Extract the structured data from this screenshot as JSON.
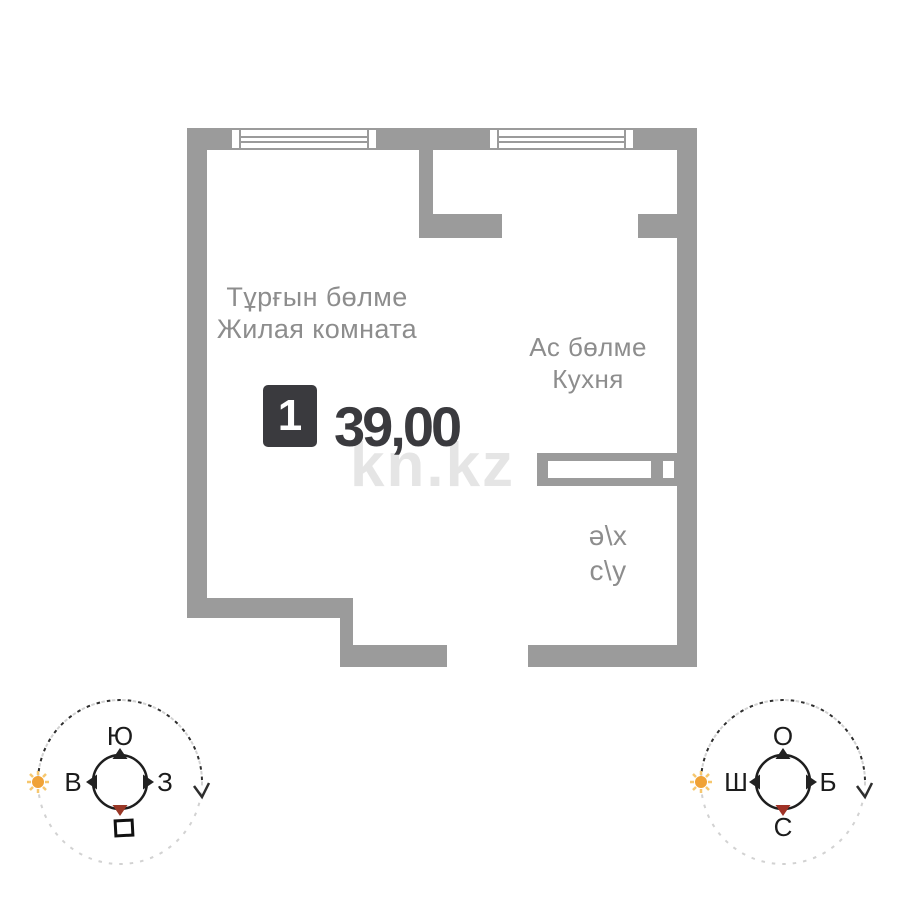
{
  "plan": {
    "watermark": "kn.kz",
    "unit": {
      "badge": "1",
      "area": "39,00"
    },
    "rooms": {
      "living": {
        "kk": "Тұрғын бөлме",
        "ru": "Жилая комната"
      },
      "kitchen": {
        "kk": "Ас бөлме",
        "ru": "Кухня"
      },
      "sanunit": {
        "kk": "ә\\х",
        "ru": "с\\у"
      }
    },
    "colors": {
      "wall": "#9b9b9b",
      "room_label": "#8d8d8d",
      "accent_dark": "#3a3a3e",
      "watermark": "#cccccc",
      "north_marker": "#993726",
      "sun": "#f0a236"
    }
  },
  "compass_ru": {
    "top": "Ю",
    "left": "В",
    "right": "З"
  },
  "compass_kk": {
    "top": "О",
    "left": "Ш",
    "right": "Б",
    "bottom": "С"
  }
}
